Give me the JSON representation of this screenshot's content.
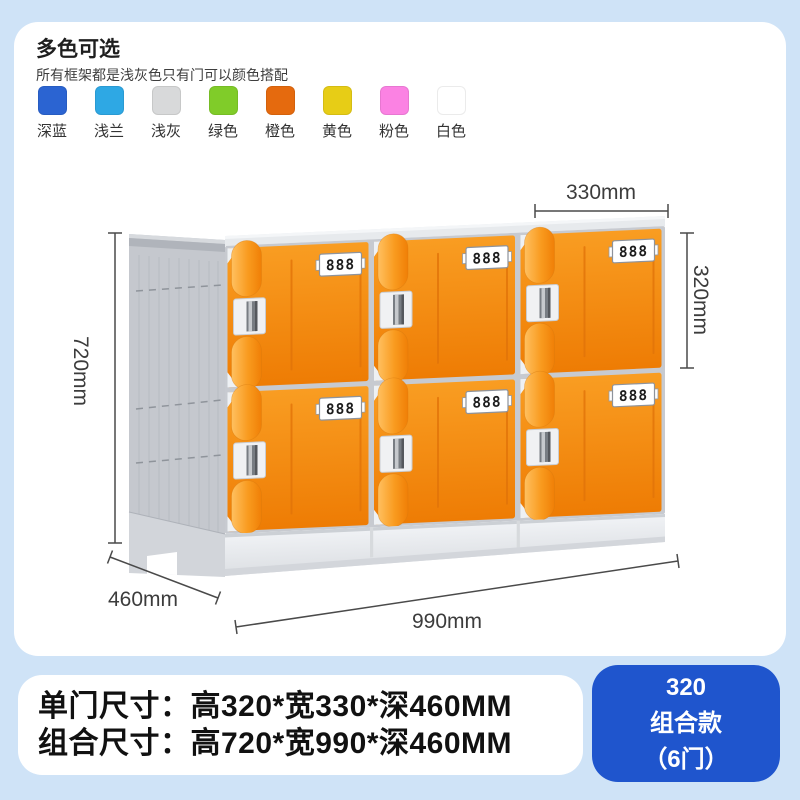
{
  "color_section": {
    "title": "多色可选",
    "subtitle": "所有框架都是浅灰色只有门可以颜色搭配",
    "swatches": [
      {
        "label": "深蓝",
        "color": "#2b64d2"
      },
      {
        "label": "浅兰",
        "color": "#2ea8e4"
      },
      {
        "label": "浅灰",
        "color": "#d8d9da"
      },
      {
        "label": "绿色",
        "color": "#80cc29"
      },
      {
        "label": "橙色",
        "color": "#e56a0e"
      },
      {
        "label": "黄色",
        "color": "#e7cd16"
      },
      {
        "label": "粉色",
        "color": "#fb82e3"
      },
      {
        "label": "白色",
        "color": "#ffffff"
      }
    ]
  },
  "diagram": {
    "door_plate": "888",
    "doors": {
      "rows": 2,
      "cols": 3
    },
    "dimensions": {
      "top_width": "330mm",
      "door_height": "320mm",
      "total_height": "720mm",
      "depth": "460mm",
      "total_width": "990mm"
    },
    "colors": {
      "door_light": "#f99d22",
      "door_dark": "#ee7c04",
      "pill_light": "#ffc060",
      "pill_mid": "#f99b1f",
      "pill_dark": "#f07f06"
    }
  },
  "specs": {
    "line1": "单门尺寸：高320*宽330*深460MM",
    "line2": "组合尺寸：高720*宽990*深460MM"
  },
  "badge": {
    "line1": "320",
    "line2": "组合款",
    "line3": "（6门）",
    "color": "#1f55cd"
  }
}
